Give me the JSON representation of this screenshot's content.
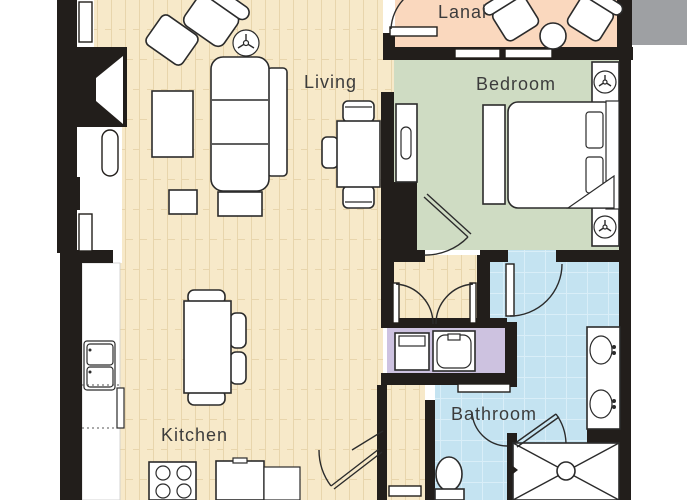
{
  "title": "Resort suite floor plan",
  "rooms": {
    "lanai": {
      "label": "Lanai",
      "color": "#fad8be"
    },
    "living": {
      "label": "Living",
      "color": "#f7e9c9"
    },
    "bedroom": {
      "label": "Bedroom",
      "color": "#cfdcc3"
    },
    "kitchen": {
      "label": "Kitchen",
      "color": "#f7e9c9"
    },
    "bathroom": {
      "label": "Bathroom",
      "color": "#c4e3f1"
    },
    "laundry": {
      "color": "#cdc2e0"
    }
  },
  "palette": {
    "wall": "#221e1b",
    "furniture_outline": "#2b2b2b",
    "gray_bar": "#9ea0a3",
    "label_text": "#3c3c3c",
    "floor_plank_line": "#e8d5ac",
    "tile_line": "#d9eef8"
  },
  "furniture_icons": [
    "armchair-icon",
    "ottoman-icon",
    "ceiling-fan-icon",
    "sofa-icon",
    "coffee-table-icon",
    "side-table-icon",
    "dining-table-icon",
    "kitchen-table-icon",
    "stove-icon",
    "refrigerator-icon",
    "kitchen-sink-icon",
    "bed-icon",
    "nightstand-icon",
    "lamp-icon",
    "dresser-icon",
    "washer-icon",
    "dryer-icon",
    "toilet-icon",
    "shower-icon",
    "vanity-sink-icon",
    "lanai-chair-icon",
    "lanai-table-icon",
    "door-swing-icon",
    "window-icon"
  ]
}
